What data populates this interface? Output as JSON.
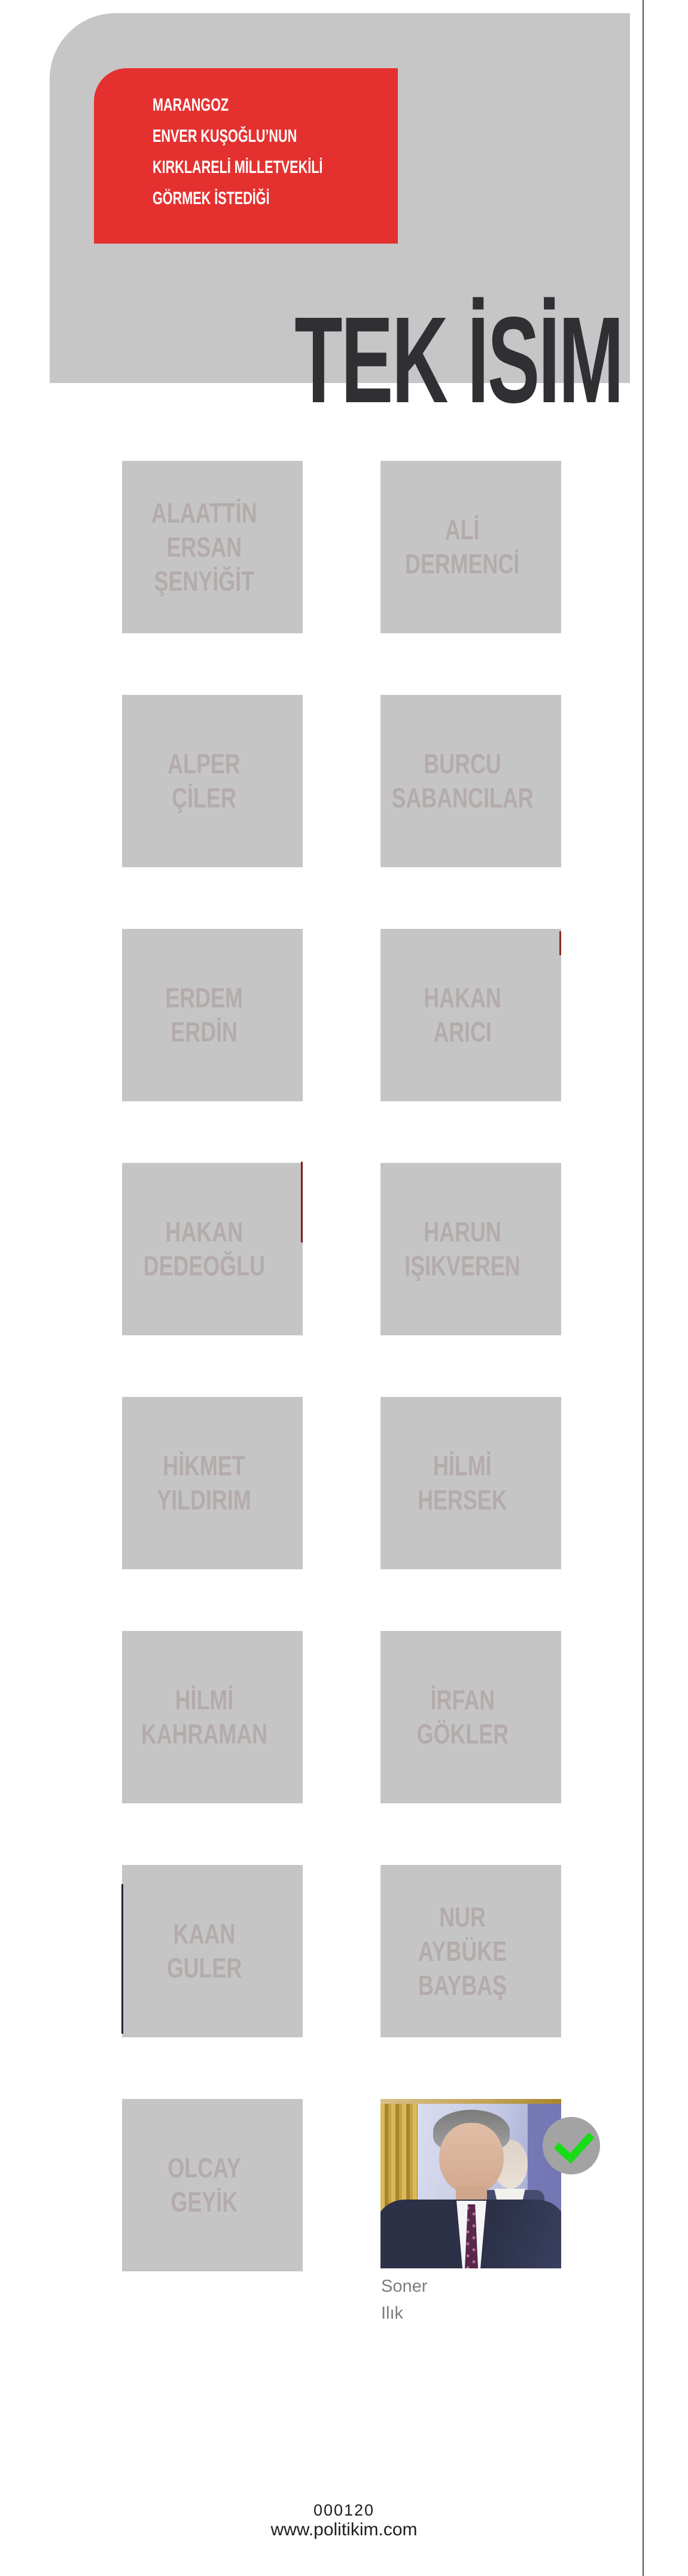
{
  "header": {
    "kicker_lines": [
      "MARANGOZ",
      "ENVER KUŞOĞLU’NUN",
      "KIRKLARELİ MİLLETVEKİLİ",
      "GÖRMEK İSTEDİĞİ"
    ],
    "title": "TEK İSİM",
    "red_color": "#e43130",
    "panel_gray": "#c6c6c6",
    "title_color": "#302f33"
  },
  "grid": {
    "box_gray": "#c6c5c5",
    "name_color": "#b4abab",
    "candidates": [
      {
        "name": "ALAATTİN ERSAN ŞENYİĞİT",
        "lines": [
          "ALAATTİN",
          "ERSAN",
          "ŞENYİĞİT"
        ]
      },
      {
        "name": "ALİ DERMENCİ",
        "lines": [
          "ALİ",
          "DERMENCİ"
        ]
      },
      {
        "name": "ALPER ÇİLER",
        "lines": [
          "ALPER",
          "ÇİLER"
        ]
      },
      {
        "name": "BURCU SABANCILAR",
        "lines": [
          "BURCU",
          "SABANCILAR"
        ]
      },
      {
        "name": "ERDEM ERDİN",
        "lines": [
          "ERDEM",
          "ERDİN"
        ]
      },
      {
        "name": "HAKAN ARICI",
        "lines": [
          "HAKAN",
          "ARICI"
        ]
      },
      {
        "name": "HAKAN DEDEOĞLU",
        "lines": [
          "HAKAN",
          "DEDEOĞLU"
        ]
      },
      {
        "name": "HARUN IŞIKVEREN",
        "lines": [
          "HARUN",
          "IŞIKVEREN"
        ]
      },
      {
        "name": "HİKMET YILDIRIM",
        "lines": [
          "HİKMET",
          "YILDIRIM"
        ]
      },
      {
        "name": "HİLMİ HERSEK",
        "lines": [
          "HİLMİ",
          "HERSEK"
        ]
      },
      {
        "name": "HİLMİ KAHRAMAN",
        "lines": [
          "HİLMİ",
          "KAHRAMAN"
        ]
      },
      {
        "name": "İRFAN GÖKLER",
        "lines": [
          "İRFAN",
          "GÖKLER"
        ]
      },
      {
        "name": "KAAN GULER",
        "lines": [
          "KAAN",
          "GULER"
        ]
      },
      {
        "name": "NUR AYBÜKE BAYBAŞ",
        "lines": [
          "NUR",
          "AYBÜKE",
          "BAYBAŞ"
        ]
      },
      {
        "name": "OLCAY GEYİK",
        "lines": [
          "OLCAY",
          "GEYİK"
        ]
      }
    ],
    "selected": {
      "caption_lines": [
        "Soner",
        "Ilık"
      ],
      "check_green": "#17dc17",
      "check_circle_gray": "#a3a3a3"
    }
  },
  "footer": {
    "code": "000120",
    "url": "www.politikim.com"
  }
}
